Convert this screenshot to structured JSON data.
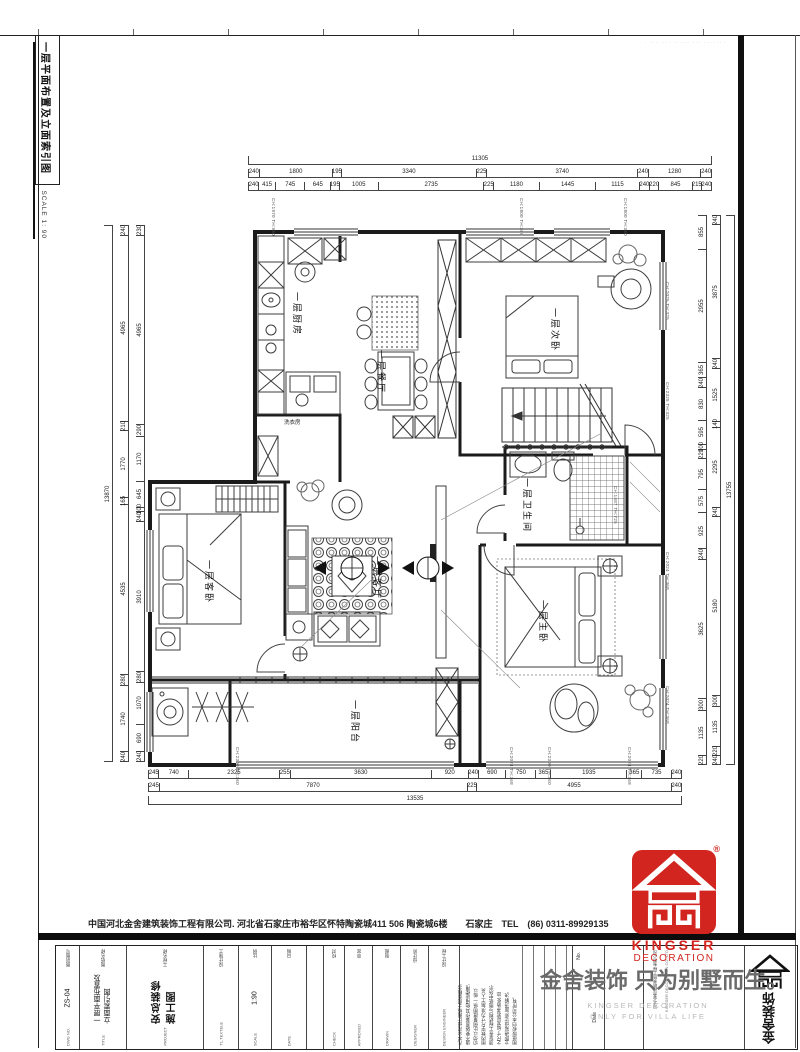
{
  "colors": {
    "logo_red": "#d2251f",
    "line_dark": "#1b1b1b"
  },
  "sidebar": {
    "title": "一层平面布置及立面索引图",
    "scale": "SCALE 1: 90"
  },
  "frame": {
    "top_watermark": "· ·· · ··· · ·· ···· · ·· · ··· ·· ·"
  },
  "rooms": {
    "kitchen": "一层厨房",
    "dining": "一层餐厅",
    "bedroom2": "一层次卧",
    "guest": "一层客卧",
    "living": "一层客厅",
    "bath": "一层卫生间",
    "master": "一层主卧",
    "balcony": "一层阳台",
    "laundry": "洗衣房"
  },
  "annotations": [
    "CH:1970 TH:950",
    "CH:1800 TH:360",
    "CH:1800 TH:360",
    "CH:2025 TH:325",
    "CH:2325 TH:325",
    "CH:1687 TH:725",
    "CH:2024 TH:368",
    "CH:2024 TH:368",
    "CH:2300 TH:360",
    "CH:2024 TH:368",
    "CH:2300 TH:360",
    "CH:2024 TH:368"
  ],
  "dimensions": {
    "top_total": [
      "11305"
    ],
    "top_row1": [
      "240",
      "1800",
      "195",
      "3340",
      "225",
      "3740",
      "240",
      "1280",
      "240"
    ],
    "top_row2": [
      "240",
      "415",
      "745",
      "645",
      "195",
      "1005",
      "2735",
      "225",
      "1180",
      "1445",
      "1115",
      "240",
      "220",
      "845",
      "215",
      "240"
    ],
    "bottom_row1": [
      "245",
      "740",
      "2325",
      "255",
      "3630",
      "920",
      "240",
      "690",
      "750",
      "365",
      "1935",
      "365",
      "735",
      "240"
    ],
    "bottom_row2": [
      "245",
      "7870",
      "225",
      "4955",
      "240"
    ],
    "bottom_total": [
      "13535"
    ],
    "left_inner": [
      "230",
      "4965",
      "290",
      "1170",
      "645",
      "100",
      "240",
      "3910",
      "280",
      "1070",
      "690",
      "240"
    ],
    "left_mid": [
      "240",
      "4965",
      "210",
      "1770",
      "165",
      "4535",
      "280",
      "1740",
      "240"
    ],
    "left_total": [
      "13870"
    ],
    "right_inner": [
      "855",
      "2955",
      "365",
      "240",
      "830",
      "595",
      "100",
      "220",
      "795",
      "575",
      "925",
      "240",
      "3625",
      "300",
      "1135",
      "220"
    ],
    "right_mid": [
      "240",
      "3875",
      "240",
      "1525",
      "140",
      "2295",
      "240",
      "5180",
      "300",
      "1135",
      "220",
      "240"
    ],
    "right_total": [
      "13755"
    ]
  },
  "footer": {
    "company_line": "中国河北金舍建筑装饰工程有限公司. 河北省石家庄市裕华区怀特陶瓷城411 506 陶瓷城6楼　　石家庄　TEL　(86) 0311-89929135",
    "title_block": {
      "columns": [
        {
          "cn": "图别图号",
          "en": "DWG NO.",
          "value": "ZS-04"
        },
        {
          "cn": "图纸名称",
          "en": "TITLE",
          "value": "一层平面布置及立面索引图"
        },
        {
          "cn": "工程名称",
          "en": "PROJECT",
          "value": "安总装修施工图"
        },
        {
          "cn": "设计施工",
          "en": "TL.TEXTELE",
          "value": ""
        },
        {
          "cn": "比例",
          "en": "SCALE",
          "value": "1:90"
        },
        {
          "cn": "日期",
          "en": "DATE",
          "value": ""
        },
        {
          "cn": "校对",
          "en": "CHECK",
          "value": ""
        },
        {
          "cn": "审定",
          "en": "APPROVED",
          "value": ""
        },
        {
          "cn": "制图",
          "en": "DRAWN",
          "value": ""
        },
        {
          "cn": "设计师",
          "en": "DESIGNER",
          "value": ""
        },
        {
          "cn": "设计工程",
          "en": "DESIGN ENGINEER",
          "value": ""
        }
      ]
    },
    "notes_lines": [
      "凡本公司设计图纸之创意概念,",
      "请不要随意兼作其他用途使用,",
      "切勿以比例量度图纸,一般以",
      "图内数字尺寸为准,施工人员",
      "须复查工程结构与图纸中所示",
      "之尺寸,如发现有矛盾处,应",
      "立即通知设计师,面洽解决,",
      "图纸版权归本公司所有。"
    ],
    "revision_no": "No.",
    "revision_date": "Date",
    "company_col1": "河北金舍建筑装饰工程有限公司",
    "company_col2": "KINGSER DECORATION CO.,LTD",
    "brand_vertical": "金舍装饰",
    "watermark_main": "金舍装饰 只为别墅而生。",
    "watermark_sub1": "KINGSER DECORATION",
    "watermark_sub2": "ONLY FOR VILLA LIFE",
    "logo_en1": "KINGSER",
    "logo_en2": "DECORATION",
    "reg_mark": "®"
  }
}
